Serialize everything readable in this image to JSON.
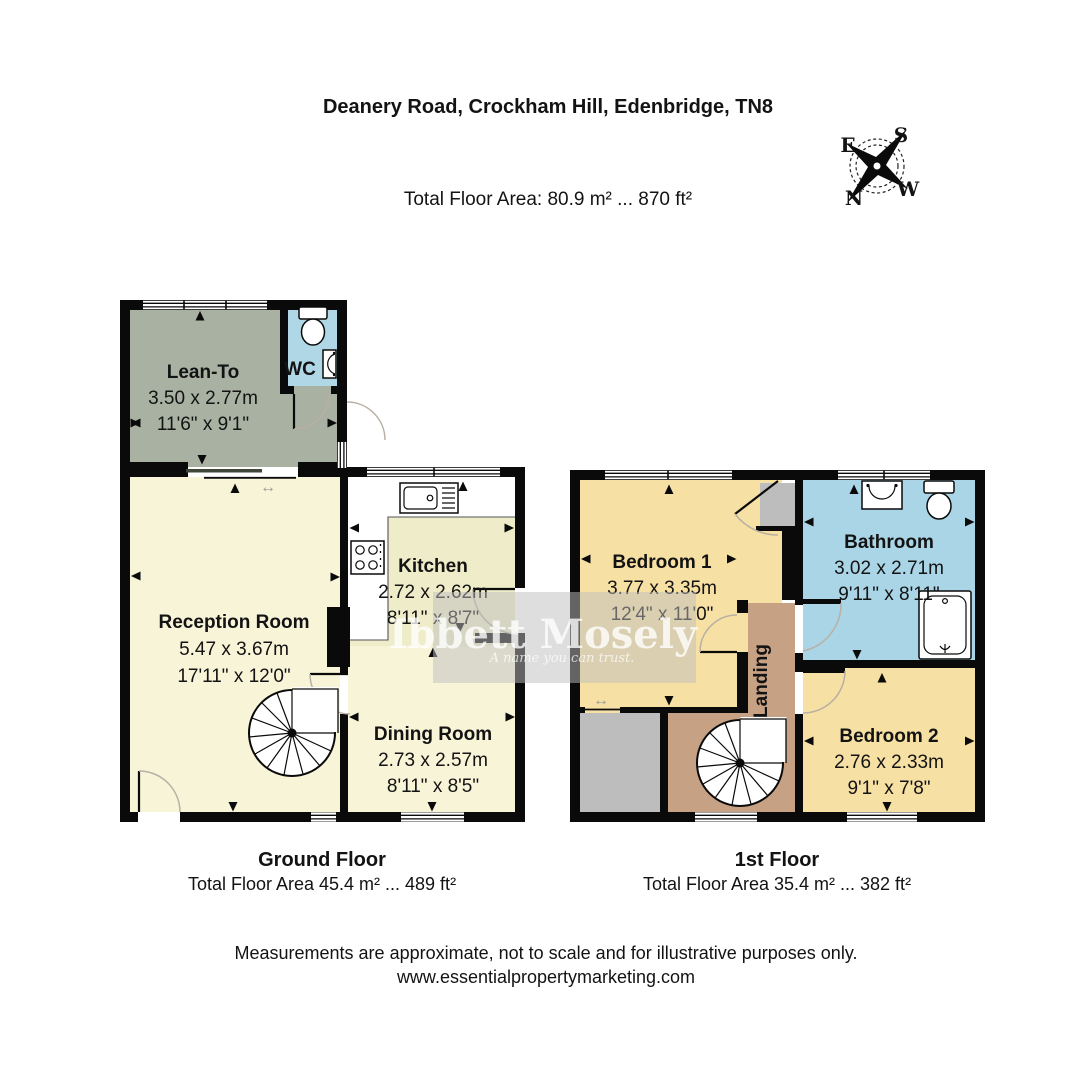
{
  "title": "Deanery Road, Crockham Hill, Edenbridge, TN8",
  "total_area": "Total Floor Area: 80.9 m² ... 870 ft²",
  "compass": {
    "top_left": "E",
    "top_right": "S",
    "bottom_left": "N",
    "bottom_right": "W"
  },
  "icons": {
    "sliding_arrow": "↔"
  },
  "ground_floor": {
    "label": "Ground Floor",
    "area": "Total Floor Area 45.4 m² ... 489 ft²",
    "rooms": {
      "lean_to": {
        "name": "Lean-To",
        "metric": "3.50 x 2.77m",
        "imperial": "11'6\" x 9'1\""
      },
      "wc": {
        "name": "WC"
      },
      "reception": {
        "name": "Reception Room",
        "metric": "5.47 x 3.67m",
        "imperial": "17'11\" x 12'0\""
      },
      "kitchen": {
        "name": "Kitchen",
        "metric": "2.72 x 2.62m",
        "imperial": "8'11\" x 8'7\""
      },
      "dining": {
        "name": "Dining Room",
        "metric": "2.73 x 2.57m",
        "imperial": "8'11\" x 8'5\""
      }
    }
  },
  "first_floor": {
    "label": "1st Floor",
    "area": "Total Floor Area 35.4 m² ... 382 ft²",
    "rooms": {
      "bedroom1": {
        "name": "Bedroom 1",
        "metric": "3.77 x 3.35m",
        "imperial": "12'4\" x 11'0\""
      },
      "bathroom": {
        "name": "Bathroom",
        "metric": "3.02 x 2.71m",
        "imperial": "9'11\" x 8'11\""
      },
      "landing": {
        "name": "Landing"
      },
      "bedroom2": {
        "name": "Bedroom 2",
        "metric": "2.76 x 2.33m",
        "imperial": "9'1\" x 7'8\""
      }
    }
  },
  "watermark": {
    "line1": "Ibbett Mosely",
    "line2": "A name you can trust."
  },
  "footer": {
    "line1": "Measurements are approximate, not to scale and for illustrative purposes only.",
    "line2": "www.essentialpropertymarketing.com"
  },
  "colors": {
    "lean_to": "#a9b1a2",
    "wc": "#b0d7e5",
    "cream": "#f8f4d8",
    "kitchen": "#efecca",
    "bedroom": "#f6e0a3",
    "bathroom": "#aad5e6",
    "landing": "#c7a184",
    "block_grey": "#bdbdbd",
    "wall": "#0a0a0a"
  }
}
